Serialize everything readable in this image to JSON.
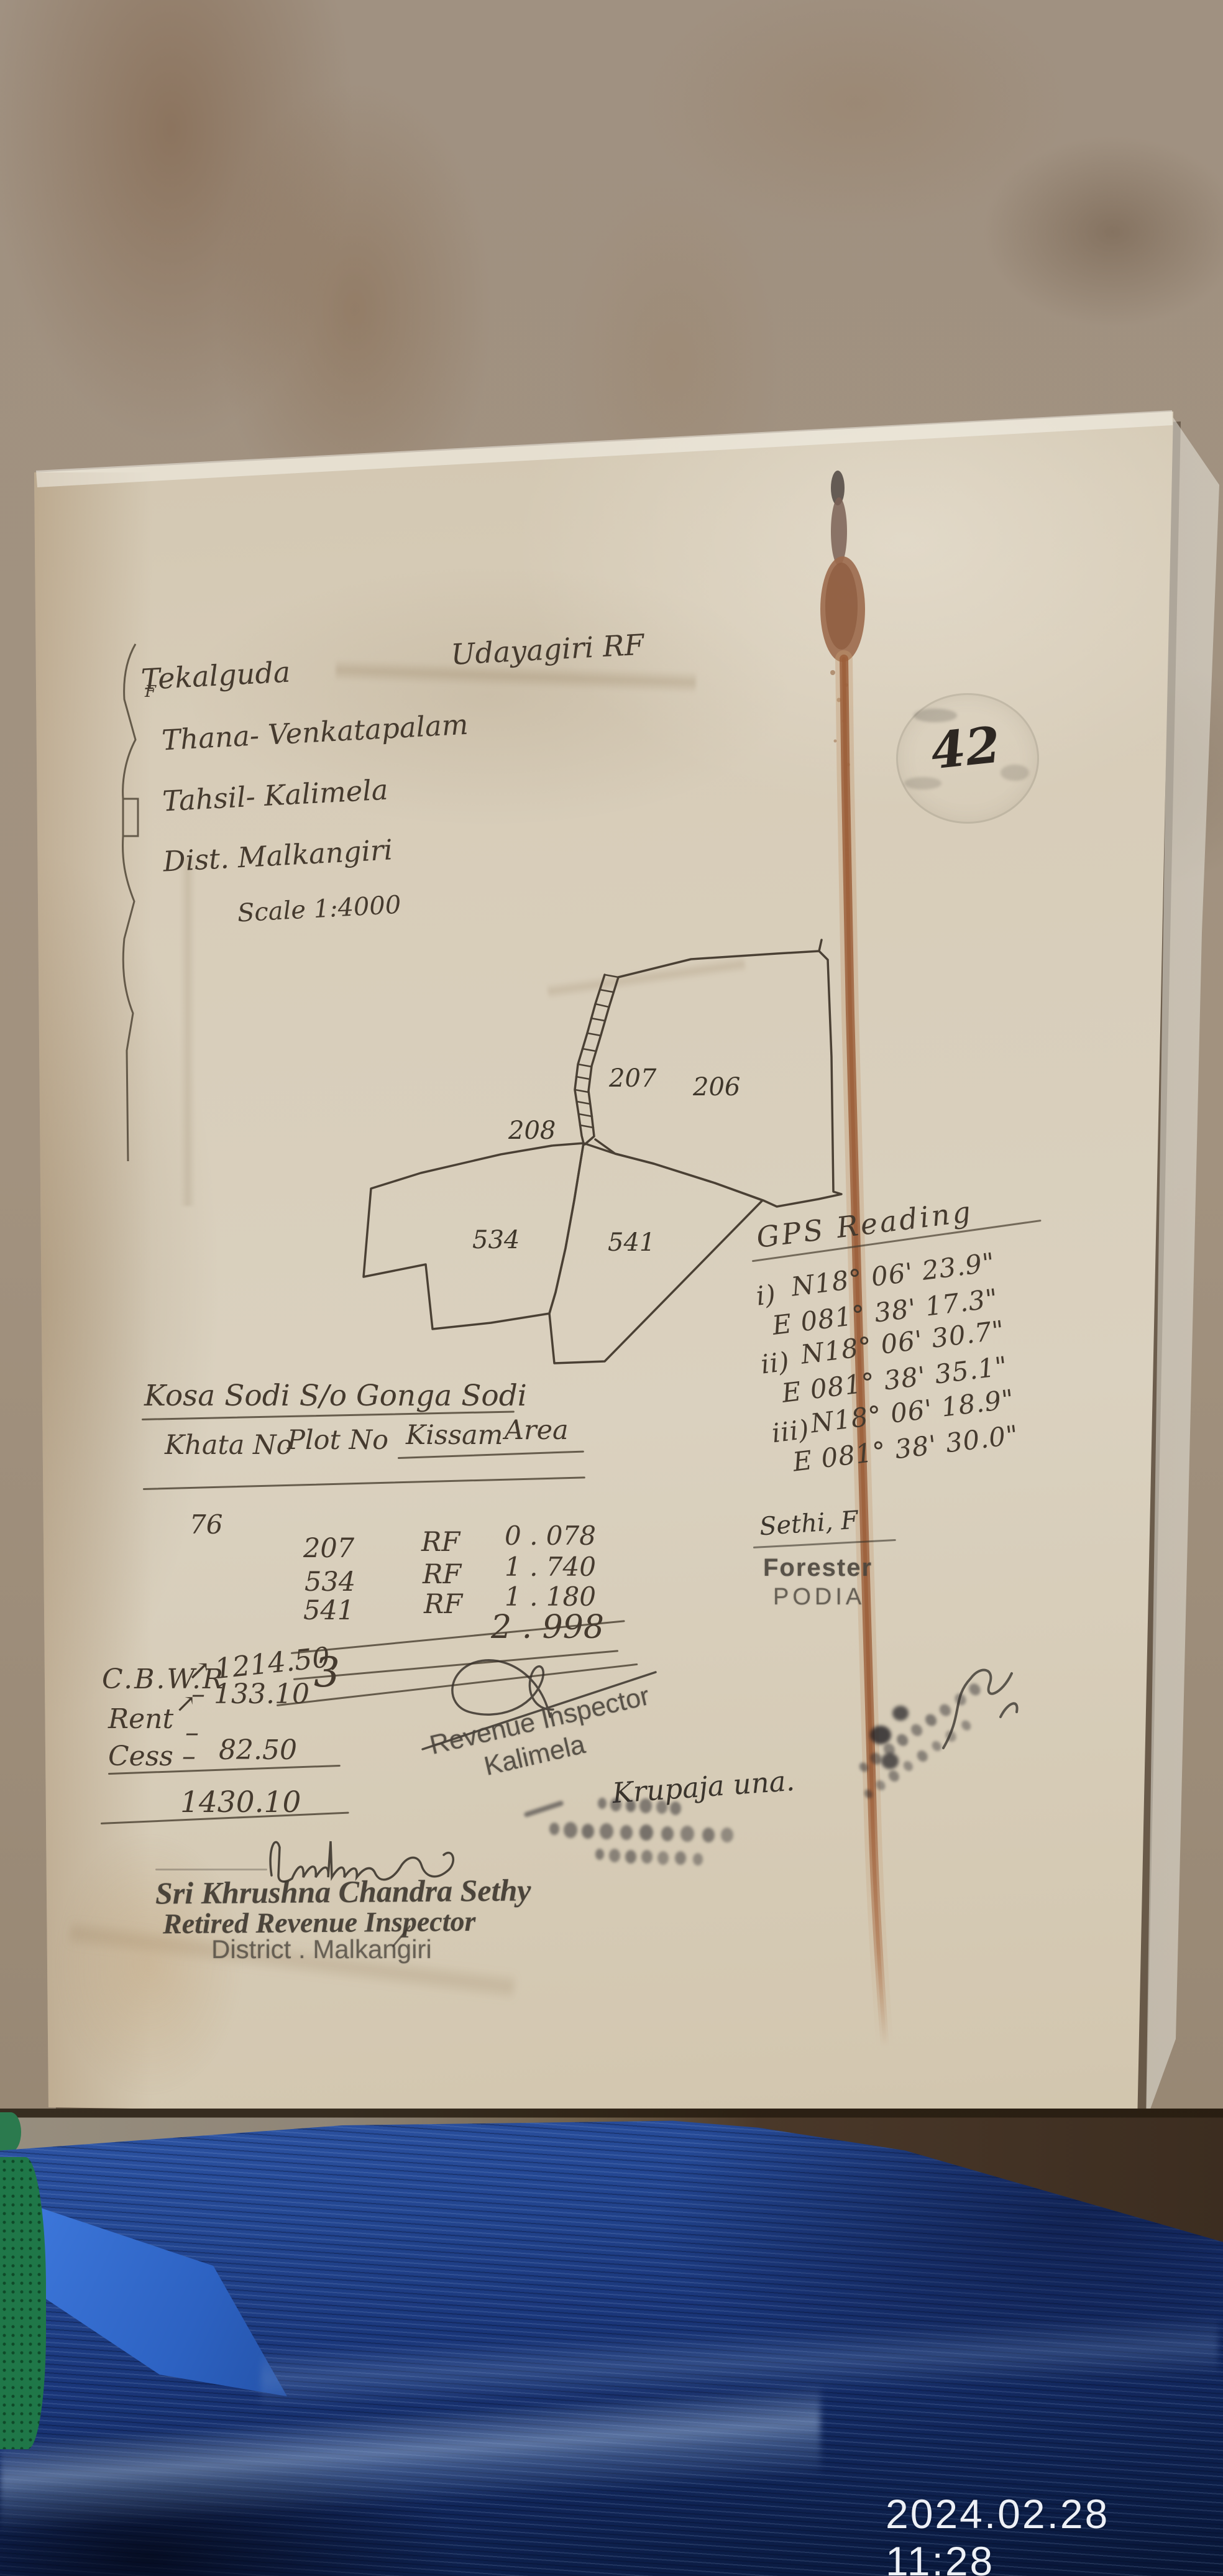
{
  "photo": {
    "timestamp": "2024.02.28 11:28"
  },
  "doc": {
    "header": {
      "village": "Tekalguda",
      "forest": "Udayagiri RF",
      "thana": "Thana- Venkatapalam",
      "tahsil": "Tahsil- Kalimela",
      "district": "Dist.  Malkangiri",
      "scale": "Scale 1:4000",
      "margin_letter": "F"
    },
    "page_no": "42",
    "map": {
      "labels": {
        "p207": "207",
        "p206": "206",
        "p208": "208",
        "p534": "534",
        "p541": "541"
      }
    },
    "gps": {
      "title": "GPS Reading",
      "readings": [
        {
          "idx": "i)",
          "n": "N18° 06' 23.9\"",
          "e": "E 081° 38' 17.3\""
        },
        {
          "idx": "ii)",
          "n": "N18° 06' 30.7\"",
          "e": "E 081° 38' 35.1\""
        },
        {
          "idx": "iii)",
          "n": "N18° 06' 18.9\"",
          "e": "E 081° 38' 30.0\""
        }
      ]
    },
    "owner": "Kosa Sodi  S/o  Gonga Sodi",
    "table": {
      "h_khata": "Khata No",
      "h_plot": "Plot No",
      "h_kissam": "Kissam",
      "h_area": "Area",
      "khata_no": "76",
      "rows": [
        {
          "plot": "207",
          "kissam": "RF",
          "area": "0 . 078"
        },
        {
          "plot": "534",
          "kissam": "RF",
          "area": "1 . 740"
        },
        {
          "plot": "541",
          "kissam": "RF",
          "area": "1 . 180"
        }
      ],
      "total": "2 . 998",
      "total_mark": "3"
    },
    "figures": {
      "cbwr_revised": "1214.50,",
      "arrow": "↗",
      "cbwr_label": "C.B.W.R",
      "cbwr_amount": "– 133.10",
      "rent_label": "Rent",
      "rent_dash": "–",
      "cess_label": "Cess –",
      "cess_amount": "82.50",
      "grand_total": "1430.10"
    },
    "ri_stamp": {
      "line1": "Revenue Inspector",
      "line2": "Kalimela"
    },
    "forester": {
      "sig": "Sethi, F",
      "title": "Forester",
      "place": "PODIA"
    },
    "note": "Krupaja una.",
    "retired_stamp": {
      "name": "Sri Khrushna Chandra Sethy",
      "title": "Retired Revenue Inspector",
      "district": "District . Malkangiri"
    }
  }
}
